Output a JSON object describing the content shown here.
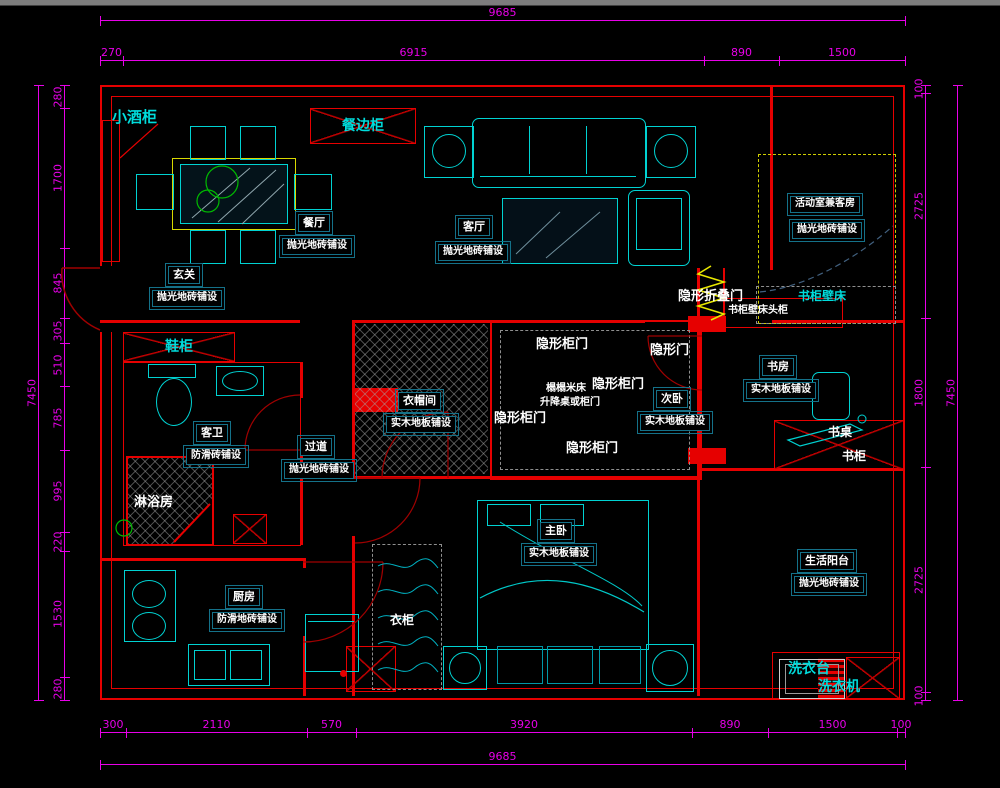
{
  "drawing": {
    "type": "apartment floor plan",
    "style": "CAD"
  },
  "colors": {
    "background": "#000000",
    "dimension": "#e800e8",
    "wall": "#e60000",
    "door_arc": "#a00000",
    "furniture": "#00d2d2",
    "table": "#d8d800",
    "plant": "#00bb00",
    "label_border": "#147189",
    "label_text": "#ffffff",
    "cyan_text": "#00dcdc"
  },
  "dims": {
    "top": {
      "overall": "9685",
      "chain": [
        "270",
        "6915",
        "890",
        "1500"
      ]
    },
    "bottom": {
      "overall": "9685",
      "chain": [
        "300",
        "2110",
        "570",
        "3920",
        "890",
        "1500",
        "100"
      ]
    },
    "left": {
      "overall": "7450",
      "chain": [
        "280",
        "1700",
        "845",
        "305",
        "510",
        "785",
        "995",
        "220",
        "1530",
        "280"
      ]
    },
    "right": {
      "overall": "7450",
      "chain": [
        "100",
        "2725",
        "1800",
        "2725",
        "100"
      ]
    }
  },
  "rooms": {
    "entry": {
      "name": "玄关",
      "floor": "抛光地砖铺设"
    },
    "dining": {
      "name": "餐厅",
      "floor": "抛光地砖铺设"
    },
    "living": {
      "name": "客厅",
      "floor": "抛光地砖铺设"
    },
    "activity": {
      "name": "活动室兼客房",
      "floor": "抛光地砖铺设"
    },
    "study": {
      "name": "书房",
      "floor": "实木地板铺设"
    },
    "second_bed": {
      "name": "次卧",
      "floor": "实木地板铺设"
    },
    "cloak": {
      "name": "衣帽间",
      "floor": "实木地板铺设"
    },
    "hall": {
      "name": "过道",
      "floor": "抛光地砖铺设"
    },
    "bath": {
      "name": "客卫",
      "floor": "防滑砖铺设"
    },
    "kitchen": {
      "name": "厨房",
      "floor": "防滑地砖铺设"
    },
    "master": {
      "name": "主卧",
      "floor": "实木地板铺设"
    },
    "balcony": {
      "name": "生活阳台",
      "floor": "抛光地砖铺设"
    }
  },
  "labels": {
    "wine_cabinet": "小酒柜",
    "sideboard": "餐边柜",
    "shoe_cabinet": "鞋柜",
    "shower_room": "淋浴房",
    "wardrobe": "衣柜",
    "hidden_cabinet_door": "隐形柜门",
    "hidden_door": "隐形门",
    "hidden_folding_door": "隐形折叠门",
    "tatami_bed": "榻榻米床",
    "lift_table_or_cabinet": "升降桌或柜门",
    "bookcase_wall_bed": "书柜壁床",
    "bookcase_wall_bed_headboard": "书柜壁床头柜",
    "desk": "书桌",
    "bookcase": "书柜",
    "laundry_counter": "洗衣台",
    "washing_machine": "洗衣机"
  }
}
